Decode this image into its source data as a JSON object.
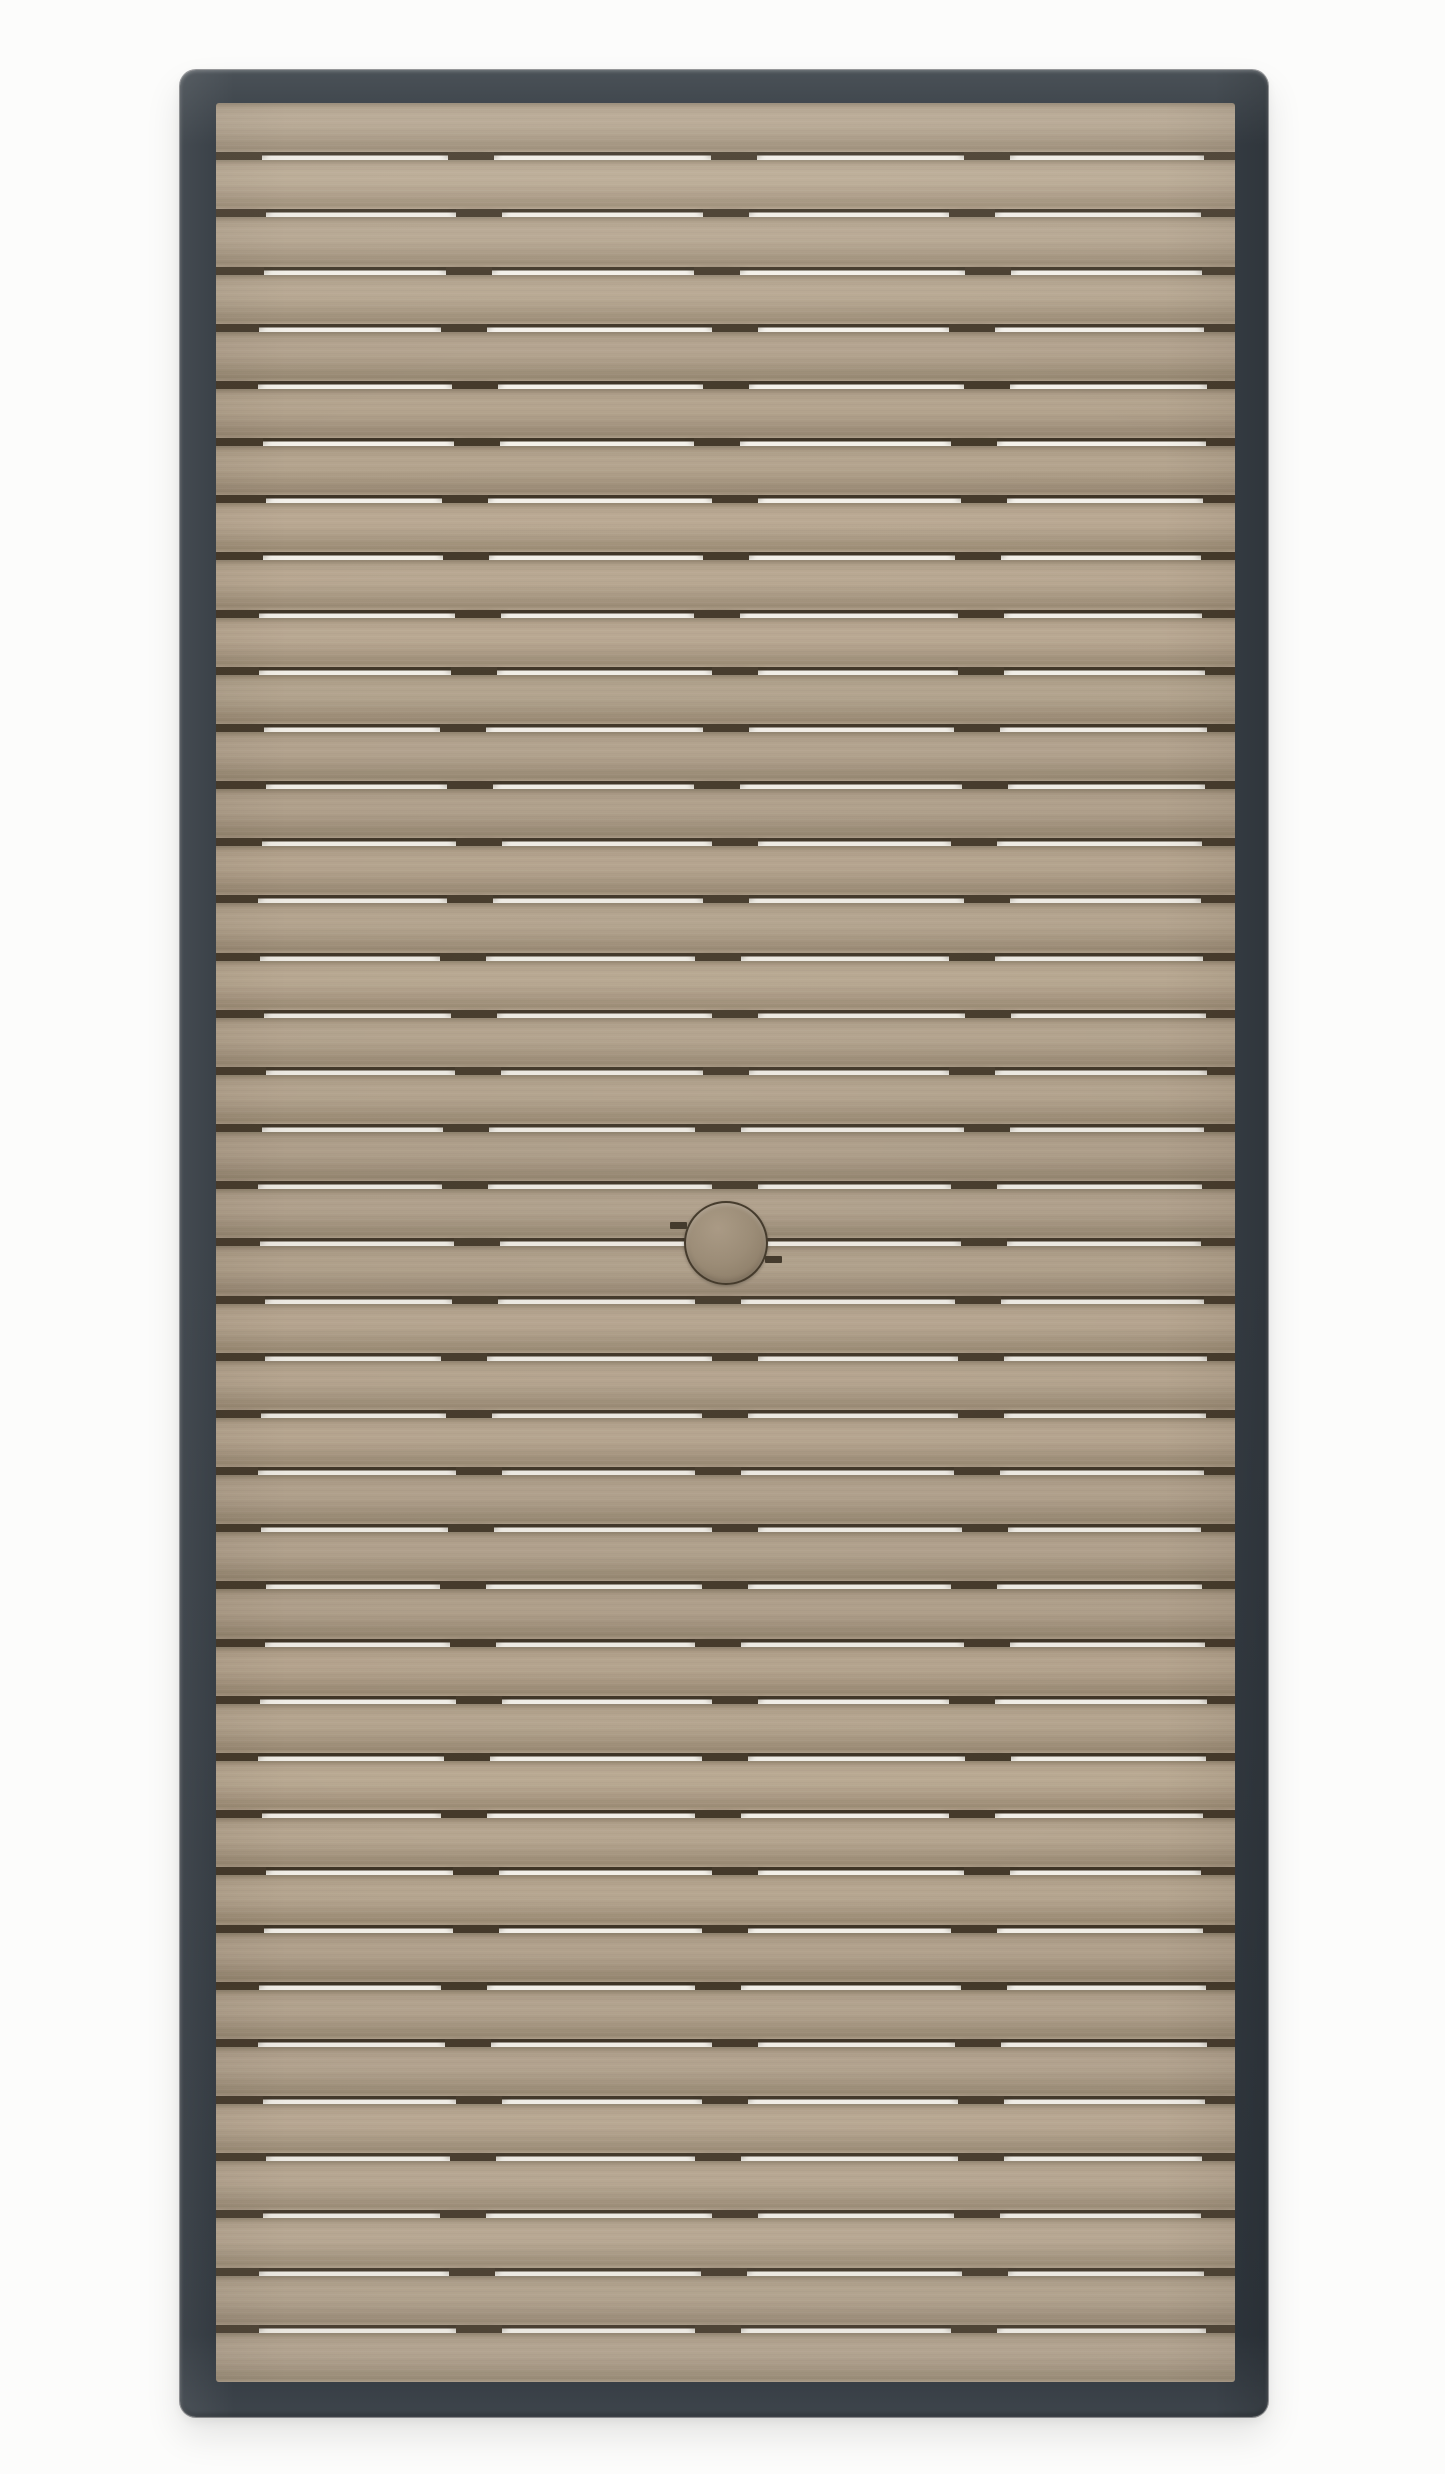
{
  "scene": {
    "type": "product-photo",
    "subject": "Rectangular slatted outdoor table top with dark metal frame and center umbrella hole plug, photographed top-down on a white background",
    "background_color": "#fcfcfb"
  },
  "table": {
    "frame": {
      "color": "#363d44",
      "highlight_color": "#4a5157",
      "highlight_bottom_color": "#3e454c",
      "shadow_color": "#2f363d",
      "corner_radius_px": 16
    },
    "slats": {
      "count": 40,
      "base_color": "#ab9b85",
      "light_color": "#b6a690",
      "deep_color": "#9a8a74",
      "top_edge_shadow_color": "#8c7e69",
      "gap_px": 8,
      "gap_light_color": "#f4f1ea",
      "gap_shadow_color": "#3e3426",
      "joint_dash_color": "#44392a",
      "joint_positions_pct": [
        0,
        25,
        50,
        75,
        100
      ],
      "joint_width_px": 46,
      "left_edge_joint_width_px": 46,
      "right_edge_joint_width_px": 31
    },
    "umbrella_plug": {
      "diameter_px": 80,
      "fill_color": "#9d8d77",
      "light_color": "#ac9c86",
      "deep_color": "#8d7d67",
      "ring_color": "#3f3526",
      "position": "center"
    }
  }
}
